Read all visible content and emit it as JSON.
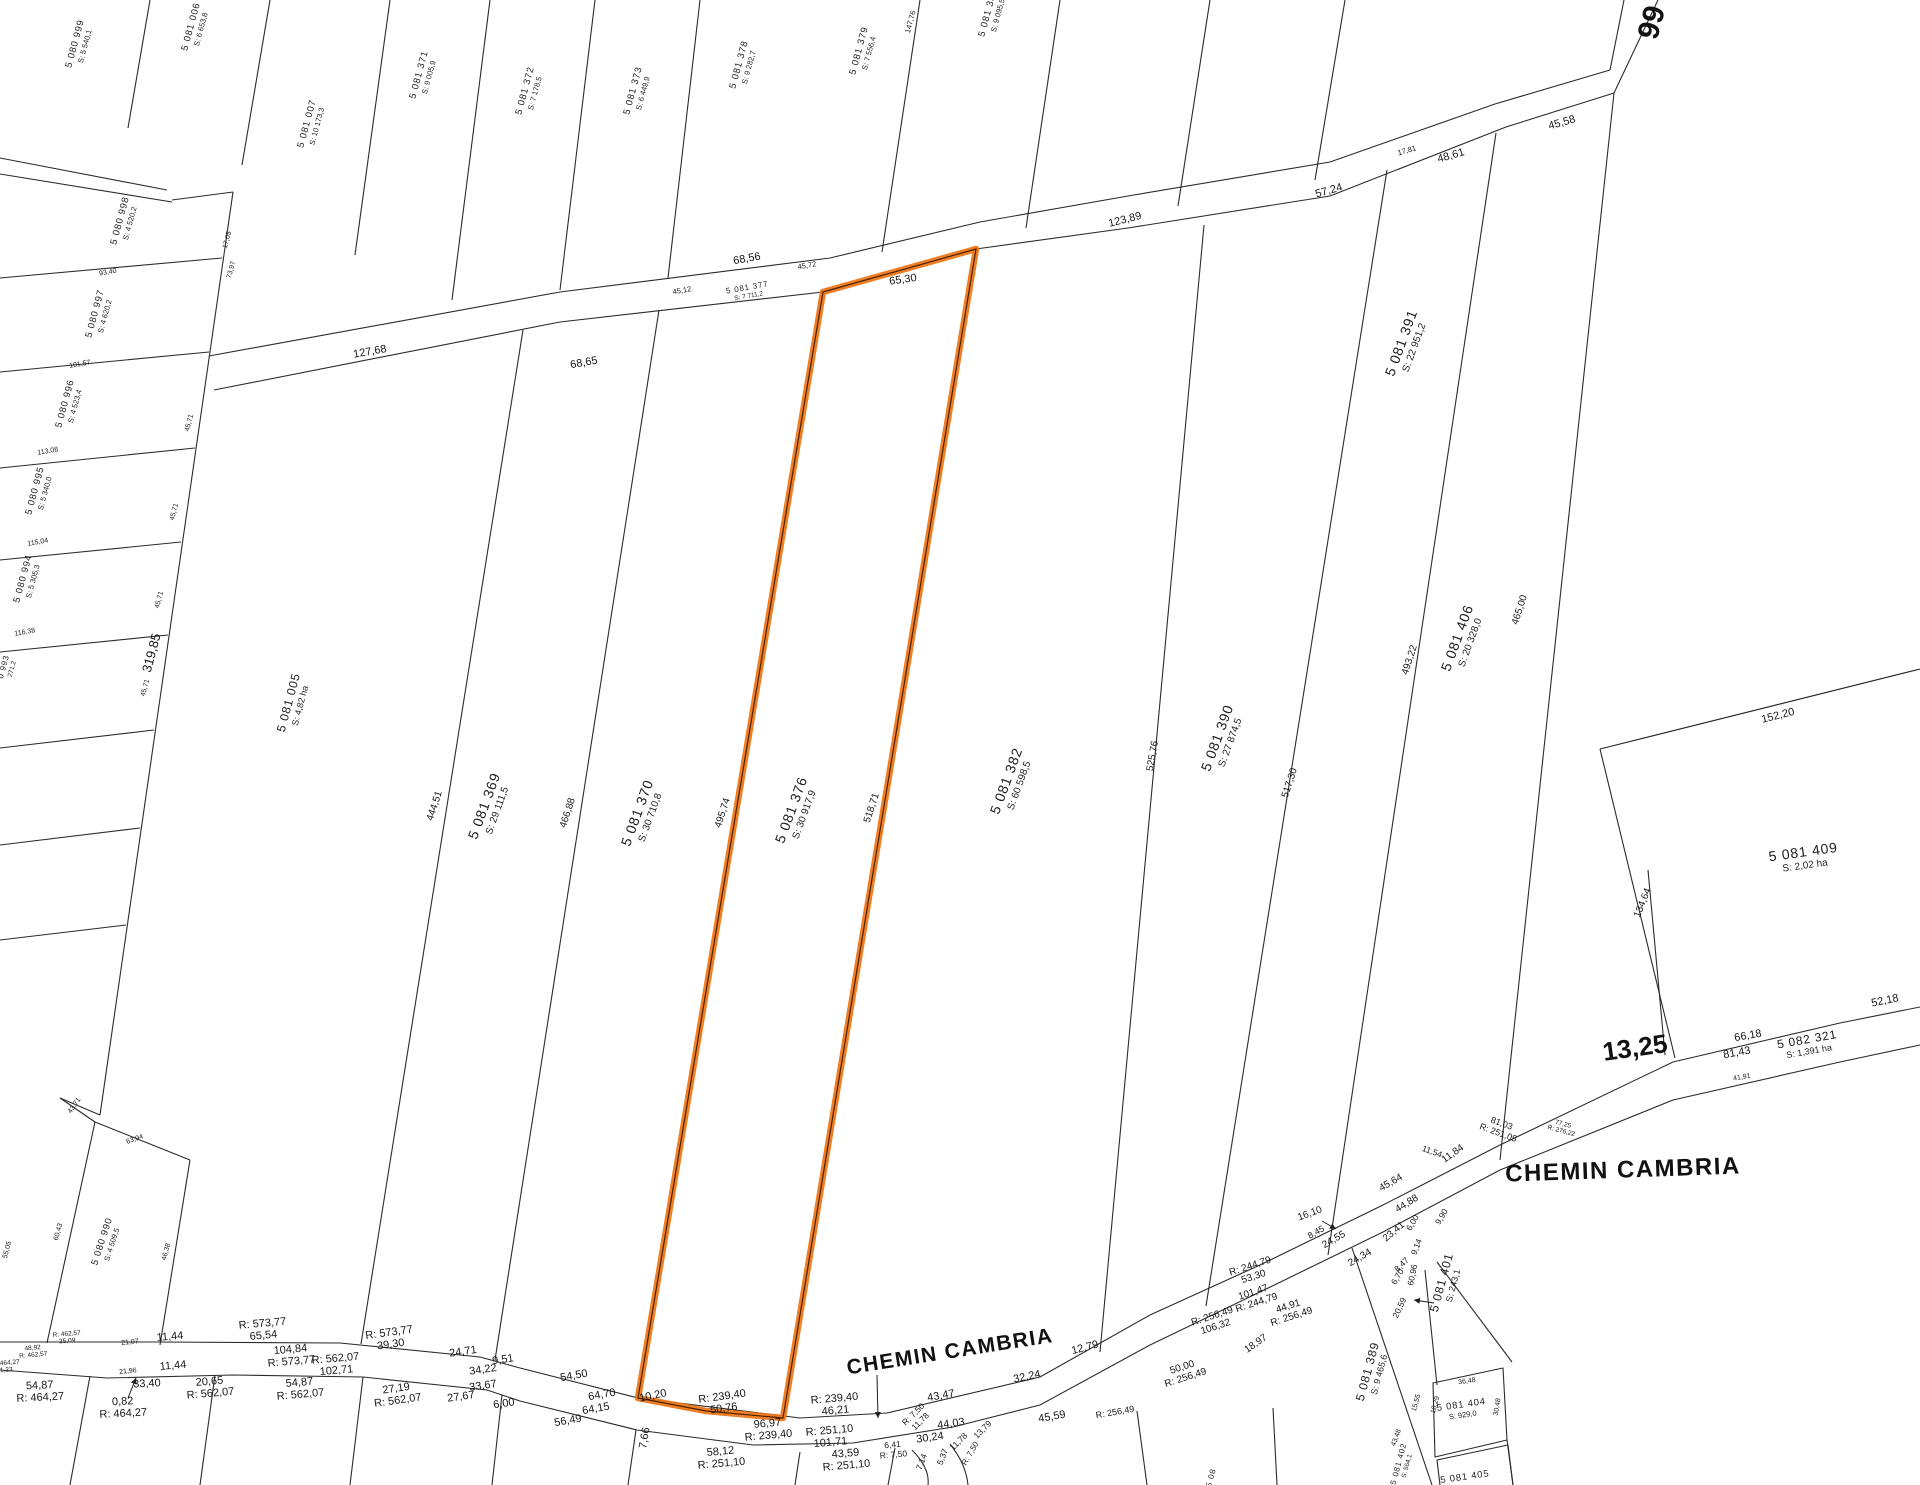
{
  "map": {
    "type": "cadastral-parcel-map",
    "road_name": "CHEMIN CAMBRIA",
    "route_number": "66",
    "highlight_color": "#EE7312",
    "highlight_core_color": "#4a2300",
    "line_color": "#2b2b2b",
    "highlighted_parcel": {
      "id": "5 081 376",
      "area": "S: 30 917,9"
    }
  },
  "parcels": [
    {
      "id": "5 080 999",
      "area": "S: 5 540,1",
      "x": 80,
      "y": 45,
      "r": -75,
      "sz": "sm",
      "hl": false
    },
    {
      "id": "5 081 006",
      "area": "S: 6 653,8",
      "x": 196,
      "y": 28,
      "r": -75,
      "sz": "sm",
      "hl": false
    },
    {
      "id": "5 081 007",
      "area": "S: 10 173,3",
      "x": 312,
      "y": 125,
      "r": -75,
      "sz": "sm",
      "hl": false
    },
    {
      "id": "5 081 371",
      "area": "S: 9 005,9",
      "x": 424,
      "y": 76,
      "r": -75,
      "sz": "sm",
      "hl": false
    },
    {
      "id": "5 081 372",
      "area": "S: 7 178,5",
      "x": 530,
      "y": 92,
      "r": -75,
      "sz": "sm",
      "hl": false
    },
    {
      "id": "5 081 373",
      "area": "S: 6 449,9",
      "x": 638,
      "y": 92,
      "r": -75,
      "sz": "sm",
      "hl": false
    },
    {
      "id": "5 081 378",
      "area": "S: 9 282,7",
      "x": 744,
      "y": 66,
      "r": -75,
      "sz": "sm",
      "hl": false
    },
    {
      "id": "5 081 379",
      "area": "S: 7 556,4",
      "x": 864,
      "y": 52,
      "r": -75,
      "sz": "sm",
      "hl": false
    },
    {
      "id": "5 081 383",
      "area": "S: 9 095,5",
      "x": 993,
      "y": 14,
      "r": -75,
      "sz": "sm",
      "hl": false
    },
    {
      "id": "5 081 377",
      "area": "S: 7 711,2",
      "x": 748,
      "y": 292,
      "r": -10,
      "sz": "xs",
      "hl": false
    },
    {
      "id": "5 080 998",
      "area": "S: 4 520,2",
      "x": 125,
      "y": 222,
      "r": -75,
      "sz": "sm",
      "hl": false
    },
    {
      "id": "5 080 997",
      "area": "S: 4 620,2",
      "x": 100,
      "y": 315,
      "r": -75,
      "sz": "sm",
      "hl": false
    },
    {
      "id": "5 080 996",
      "area": "S: 4 523,4",
      "x": 70,
      "y": 405,
      "r": -75,
      "sz": "sm",
      "hl": false
    },
    {
      "id": "5 080 995",
      "area": "S: 5 340,0",
      "x": 40,
      "y": 492,
      "r": -75,
      "sz": "sm",
      "hl": false
    },
    {
      "id": "5 080 994",
      "area": "S: 5 305,3",
      "x": 28,
      "y": 580,
      "r": -75,
      "sz": "sm",
      "hl": false
    },
    {
      "id": "0 993",
      "area": "271,2",
      "x": 8,
      "y": 668,
      "r": -75,
      "sz": "xs",
      "hl": false
    },
    {
      "id": "5 080 990",
      "area": "S: 4 509,5",
      "x": 107,
      "y": 1243,
      "r": -72,
      "sz": "sm",
      "hl": false
    },
    {
      "id": "5 081 005",
      "area": "S: 4,82  ha",
      "x": 294,
      "y": 704,
      "r": -75,
      "sz": "md",
      "hl": false
    },
    {
      "id": "5 081 369",
      "area": "S: 29 111,5",
      "x": 490,
      "y": 808,
      "r": -70,
      "sz": "lg",
      "hl": false
    },
    {
      "id": "5 081 370",
      "area": "S: 30 710,8",
      "x": 643,
      "y": 815,
      "r": -70,
      "sz": "lg",
      "hl": false
    },
    {
      "id": "5 081 376",
      "area": "S: 30 917,9",
      "x": 797,
      "y": 812,
      "r": -70,
      "sz": "lg",
      "hl": true
    },
    {
      "id": "5 081 382",
      "area": "S: 60 598,5",
      "x": 1012,
      "y": 783,
      "r": -70,
      "sz": "lg",
      "hl": false
    },
    {
      "id": "5 081 390",
      "area": "S: 27 874,5",
      "x": 1223,
      "y": 740,
      "r": -70,
      "sz": "lg",
      "hl": false
    },
    {
      "id": "5 081 391",
      "area": "S: 22 951,2",
      "x": 1407,
      "y": 345,
      "r": -70,
      "sz": "lg",
      "hl": false
    },
    {
      "id": "5 081 406",
      "area": "S: 20 328,0",
      "x": 1463,
      "y": 640,
      "r": -70,
      "sz": "lg",
      "hl": false
    },
    {
      "id": "5 081 409",
      "area": "S: 2,02  ha",
      "x": 1804,
      "y": 858,
      "r": -8,
      "sz": "lg",
      "hl": false
    },
    {
      "id": "5 082 321",
      "area": "S: 1,391 ha",
      "x": 1808,
      "y": 1045,
      "r": -10,
      "sz": "md",
      "hl": false
    },
    {
      "id": "5 081 401",
      "area": "S: 243,1",
      "x": 1447,
      "y": 1284,
      "r": -75,
      "sz": "md",
      "hl": false
    },
    {
      "id": "5 081 389",
      "area": "S: 9 465,6",
      "x": 1373,
      "y": 1373,
      "r": -75,
      "sz": "md",
      "hl": false
    },
    {
      "id": "5 081 402",
      "area": "S: 564,1",
      "x": 1403,
      "y": 1465,
      "r": -75,
      "sz": "xs",
      "hl": false
    },
    {
      "id": "5 081 404",
      "area": "S: 929,0",
      "x": 1462,
      "y": 1410,
      "r": -8,
      "sz": "sm",
      "hl": false
    },
    {
      "id": "5 081 405",
      "area": "",
      "x": 1465,
      "y": 1478,
      "r": -8,
      "sz": "sm",
      "hl": false
    },
    {
      "id": "5 08",
      "area": "",
      "x": 1212,
      "y": 1478,
      "r": -75,
      "sz": "xs",
      "hl": false
    }
  ],
  "measurements": [
    {
      "t": "127,68",
      "x": 370,
      "y": 352,
      "r": -10,
      "s": 11
    },
    {
      "t": "68,65",
      "x": 584,
      "y": 363,
      "r": -10,
      "s": 11
    },
    {
      "t": "68,56",
      "x": 747,
      "y": 259,
      "r": -10,
      "s": 11
    },
    {
      "t": "65,30",
      "x": 903,
      "y": 280,
      "r": -8,
      "s": 11
    },
    {
      "t": "123,89",
      "x": 1125,
      "y": 220,
      "r": -14,
      "s": 11
    },
    {
      "t": "57,24",
      "x": 1329,
      "y": 191,
      "r": -16,
      "s": 11
    },
    {
      "t": "48,61",
      "x": 1451,
      "y": 156,
      "r": -16,
      "s": 11
    },
    {
      "t": "45,58",
      "x": 1562,
      "y": 123,
      "r": -16,
      "s": 11
    },
    {
      "t": "17,81",
      "x": 1407,
      "y": 151,
      "r": -16,
      "s": 7.5
    },
    {
      "t": "45,72",
      "x": 807,
      "y": 266,
      "r": -10,
      "s": 7.5
    },
    {
      "t": "45,12",
      "x": 682,
      "y": 291,
      "r": -10,
      "s": 7.5
    },
    {
      "t": "147,76",
      "x": 911,
      "y": 22,
      "r": -75,
      "s": 7.5
    },
    {
      "t": "444,51",
      "x": 435,
      "y": 806,
      "r": -72,
      "s": 10
    },
    {
      "t": "466,88",
      "x": 568,
      "y": 813,
      "r": -72,
      "s": 10
    },
    {
      "t": "495,74",
      "x": 723,
      "y": 813,
      "r": -72,
      "s": 10
    },
    {
      "t": "518,71",
      "x": 872,
      "y": 808,
      "r": -72,
      "s": 10
    },
    {
      "t": "525,76",
      "x": 1153,
      "y": 756,
      "r": -80,
      "s": 10
    },
    {
      "t": "517,30",
      "x": 1290,
      "y": 783,
      "r": -72,
      "s": 10
    },
    {
      "t": "493,22",
      "x": 1410,
      "y": 660,
      "r": -72,
      "s": 10
    },
    {
      "t": "465,00",
      "x": 1520,
      "y": 610,
      "r": -72,
      "s": 10
    },
    {
      "t": "319,85",
      "x": 152,
      "y": 653,
      "r": -75,
      "s": 13
    },
    {
      "t": "152,20",
      "x": 1778,
      "y": 716,
      "r": -14,
      "s": 11
    },
    {
      "t": "134,64",
      "x": 1643,
      "y": 903,
      "r": -68,
      "s": 10
    },
    {
      "t": "93,40",
      "x": 108,
      "y": 273,
      "r": -10,
      "s": 7
    },
    {
      "t": "101,57",
      "x": 80,
      "y": 365,
      "r": -10,
      "s": 7
    },
    {
      "t": "113,08",
      "x": 48,
      "y": 452,
      "r": -10,
      "s": 7
    },
    {
      "t": "115,04",
      "x": 38,
      "y": 543,
      "r": -10,
      "s": 7
    },
    {
      "t": "116,38",
      "x": 25,
      "y": 633,
      "r": -10,
      "s": 7
    },
    {
      "t": "45,71",
      "x": 190,
      "y": 423,
      "r": -75,
      "s": 7
    },
    {
      "t": "45,71",
      "x": 175,
      "y": 512,
      "r": -75,
      "s": 7
    },
    {
      "t": "45,71",
      "x": 160,
      "y": 600,
      "r": -75,
      "s": 7
    },
    {
      "t": "45,71",
      "x": 146,
      "y": 688,
      "r": -75,
      "s": 7
    },
    {
      "t": "17,05",
      "x": 228,
      "y": 240,
      "r": -75,
      "s": 7
    },
    {
      "t": "73,97",
      "x": 232,
      "y": 270,
      "r": -75,
      "s": 7
    },
    {
      "t": "43,71",
      "x": 75,
      "y": 1106,
      "r": -55,
      "s": 7
    },
    {
      "t": "63,94",
      "x": 135,
      "y": 1140,
      "r": -20,
      "s": 7
    },
    {
      "t": "60,43",
      "x": 59,
      "y": 1232,
      "r": -75,
      "s": 7
    },
    {
      "t": "55,05",
      "x": 8,
      "y": 1250,
      "r": -75,
      "s": 7
    },
    {
      "t": "46,38",
      "x": 167,
      "y": 1252,
      "r": -75,
      "s": 7
    },
    {
      "t": "11,44",
      "x": 170,
      "y": 1337,
      "r": -5,
      "s": 11
    },
    {
      "t": "11,44",
      "x": 173,
      "y": 1366,
      "r": -5,
      "s": 11
    },
    {
      "t": "21,07",
      "x": 130,
      "y": 1343,
      "r": -5,
      "s": 7
    },
    {
      "t": "21,96",
      "x": 128,
      "y": 1372,
      "r": -5,
      "s": 7
    },
    {
      "t": "24,71",
      "x": 463,
      "y": 1352,
      "r": -8,
      "s": 11
    },
    {
      "t": "9,51",
      "x": 503,
      "y": 1360,
      "r": -8,
      "s": 11
    },
    {
      "t": "34,22",
      "x": 483,
      "y": 1370,
      "r": -8,
      "s": 11
    },
    {
      "t": "33,40",
      "x": 147,
      "y": 1384,
      "r": -3,
      "s": 11
    },
    {
      "t": "27,67",
      "x": 461,
      "y": 1397,
      "r": -8,
      "s": 11
    },
    {
      "t": "33,67",
      "x": 483,
      "y": 1386,
      "r": -8,
      "s": 11
    },
    {
      "t": "6,00",
      "x": 504,
      "y": 1404,
      "r": -8,
      "s": 11
    },
    {
      "t": "54,50",
      "x": 574,
      "y": 1376,
      "r": -10,
      "s": 11
    },
    {
      "t": "64,70",
      "x": 602,
      "y": 1395,
      "r": -10,
      "s": 11
    },
    {
      "t": "64,15",
      "x": 596,
      "y": 1409,
      "r": -10,
      "s": 11
    },
    {
      "t": "56,49",
      "x": 568,
      "y": 1421,
      "r": -10,
      "s": 11
    },
    {
      "t": "10,20",
      "x": 653,
      "y": 1396,
      "r": -12,
      "s": 11
    },
    {
      "t": "7,66",
      "x": 645,
      "y": 1438,
      "r": -80,
      "s": 11
    },
    {
      "t": "43,47",
      "x": 941,
      "y": 1396,
      "r": -10,
      "s": 11
    },
    {
      "t": "32,24",
      "x": 1027,
      "y": 1377,
      "r": -12,
      "s": 11
    },
    {
      "t": "44,03",
      "x": 951,
      "y": 1424,
      "r": -8,
      "s": 11
    },
    {
      "t": "30,24",
      "x": 930,
      "y": 1438,
      "r": -8,
      "s": 11
    },
    {
      "t": "45,59",
      "x": 1052,
      "y": 1417,
      "r": -10,
      "s": 11
    },
    {
      "t": "R: 256,49",
      "x": 1115,
      "y": 1412,
      "r": -10,
      "s": 9
    },
    {
      "t": "12,79",
      "x": 1085,
      "y": 1348,
      "r": -15,
      "s": 11
    },
    {
      "t": "18,97",
      "x": 1256,
      "y": 1344,
      "r": -35,
      "s": 10
    },
    {
      "t": "16,10",
      "x": 1310,
      "y": 1214,
      "r": -20,
      "s": 10
    },
    {
      "t": "8,45",
      "x": 1316,
      "y": 1232,
      "r": -30,
      "s": 9
    },
    {
      "t": "24,55",
      "x": 1334,
      "y": 1240,
      "r": -30,
      "s": 10
    },
    {
      "t": "24,34",
      "x": 1360,
      "y": 1258,
      "r": -30,
      "s": 10
    },
    {
      "t": "45,64",
      "x": 1391,
      "y": 1183,
      "r": -30,
      "s": 10
    },
    {
      "t": "44,88",
      "x": 1407,
      "y": 1204,
      "r": -32,
      "s": 10
    },
    {
      "t": "23,41",
      "x": 1394,
      "y": 1232,
      "r": -40,
      "s": 10
    },
    {
      "t": "6,00",
      "x": 1413,
      "y": 1223,
      "r": -60,
      "s": 8.5
    },
    {
      "t": "11,84",
      "x": 1453,
      "y": 1154,
      "r": -35,
      "s": 10
    },
    {
      "t": "9,90",
      "x": 1442,
      "y": 1217,
      "r": -60,
      "s": 8.5
    },
    {
      "t": "9,14",
      "x": 1417,
      "y": 1247,
      "r": -70,
      "s": 8.5
    },
    {
      "t": "8,47",
      "x": 1402,
      "y": 1265,
      "r": -45,
      "s": 8.5
    },
    {
      "t": "6,70",
      "x": 1398,
      "y": 1277,
      "r": -60,
      "s": 8.5
    },
    {
      "t": "60,96",
      "x": 1413,
      "y": 1275,
      "r": -78,
      "s": 8.5
    },
    {
      "t": "20,59",
      "x": 1400,
      "y": 1308,
      "r": -65,
      "s": 8.5
    },
    {
      "t": "11,54",
      "x": 1432,
      "y": 1152,
      "r": 20,
      "s": 8.5
    },
    {
      "t": "52,18",
      "x": 1885,
      "y": 1001,
      "r": -12,
      "s": 11
    },
    {
      "t": "66,18",
      "x": 1748,
      "y": 1036,
      "r": -10,
      "s": 11
    },
    {
      "t": "81,43",
      "x": 1737,
      "y": 1053,
      "r": -10,
      "s": 11
    },
    {
      "t": "41,91",
      "x": 1742,
      "y": 1078,
      "r": -10,
      "s": 7
    },
    {
      "t": "11,78",
      "x": 959,
      "y": 1442,
      "r": -45,
      "s": 8.5
    },
    {
      "t": "13,79",
      "x": 983,
      "y": 1430,
      "r": -45,
      "s": 8.5
    },
    {
      "t": "R: 7,50",
      "x": 971,
      "y": 1454,
      "r": -60,
      "s": 8
    },
    {
      "t": "5,37",
      "x": 943,
      "y": 1457,
      "r": -70,
      "s": 8.5
    },
    {
      "t": "7,14",
      "x": 922,
      "y": 1462,
      "r": -70,
      "s": 8.5
    },
    {
      "t": "43,48",
      "x": 1397,
      "y": 1438,
      "r": -70,
      "s": 7
    },
    {
      "t": "15,55",
      "x": 1417,
      "y": 1403,
      "r": -75,
      "s": 7
    },
    {
      "t": "18,29",
      "x": 1436,
      "y": 1405,
      "r": -75,
      "s": 7
    },
    {
      "t": "36,48",
      "x": 1467,
      "y": 1382,
      "r": -8,
      "s": 7
    },
    {
      "t": "30,48",
      "x": 1498,
      "y": 1407,
      "r": -80,
      "s": 7
    }
  ],
  "measure_pairs": [
    {
      "l1": "R: 573,77",
      "l2": "65,54",
      "x": 263,
      "y": 1330,
      "r": -5,
      "s": 11
    },
    {
      "l1": "104,84",
      "l2": "R: 573,77",
      "x": 291,
      "y": 1356,
      "r": -5,
      "s": 11
    },
    {
      "l1": "R: 562,07",
      "l2": "102,71",
      "x": 336,
      "y": 1365,
      "r": -5,
      "s": 11
    },
    {
      "l1": "R: 573,77",
      "l2": "39,30",
      "x": 390,
      "y": 1339,
      "r": -8,
      "s": 11
    },
    {
      "l1": "R: 462,57",
      "l2": "25,09",
      "x": 67,
      "y": 1338,
      "r": -5,
      "s": 6.5
    },
    {
      "l1": "48,92",
      "l2": "R: 462,57",
      "x": 33,
      "y": 1352,
      "r": -5,
      "s": 6.5
    },
    {
      "l1": "R: 464,27",
      "l2": "1,23",
      "x": 6,
      "y": 1367,
      "r": -5,
      "s": 6.5
    },
    {
      "l1": "54,87",
      "l2": "R: 464,27",
      "x": 40,
      "y": 1392,
      "r": -3,
      "s": 11
    },
    {
      "l1": "0,82",
      "l2": "R: 464,27",
      "x": 123,
      "y": 1408,
      "r": -3,
      "s": 11
    },
    {
      "l1": "20,65",
      "l2": "R: 562,07",
      "x": 210,
      "y": 1388,
      "r": -5,
      "s": 11
    },
    {
      "l1": "54,87",
      "l2": "R: 562,07",
      "x": 300,
      "y": 1389,
      "r": -5,
      "s": 11
    },
    {
      "l1": "27,19",
      "l2": "R: 562,07",
      "x": 397,
      "y": 1395,
      "r": -8,
      "s": 11
    },
    {
      "l1": "R: 239,40",
      "l2": "50,76",
      "x": 723,
      "y": 1403,
      "r": -8,
      "s": 11
    },
    {
      "l1": "96,97",
      "l2": "R: 239,40",
      "x": 768,
      "y": 1430,
      "r": -5,
      "s": 11
    },
    {
      "l1": "R: 239,40",
      "l2": "46,21",
      "x": 835,
      "y": 1405,
      "r": -5,
      "s": 11
    },
    {
      "l1": "R: 251,10",
      "l2": "101,71",
      "x": 830,
      "y": 1437,
      "r": -5,
      "s": 11
    },
    {
      "l1": "58,12",
      "l2": "R: 251,10",
      "x": 721,
      "y": 1458,
      "r": -5,
      "s": 11
    },
    {
      "l1": "43,59",
      "l2": "R: 251,10",
      "x": 846,
      "y": 1460,
      "r": -5,
      "s": 11
    },
    {
      "l1": "6,41",
      "l2": "R: 7,50",
      "x": 893,
      "y": 1450,
      "r": -5,
      "s": 8.5
    },
    {
      "l1": "R: 7,50",
      "l2": "11,78",
      "x": 917,
      "y": 1418,
      "r": -45,
      "s": 8.5
    },
    {
      "l1": "R: 244,79",
      "l2": "53,30",
      "x": 1252,
      "y": 1272,
      "r": -18,
      "s": 10
    },
    {
      "l1": "101,47",
      "l2": "R: 244,79",
      "x": 1255,
      "y": 1298,
      "r": -18,
      "s": 10
    },
    {
      "l1": "R: 256,49",
      "l2": "106,32",
      "x": 1214,
      "y": 1322,
      "r": -18,
      "s": 10
    },
    {
      "l1": "44,91",
      "l2": "R: 256,49",
      "x": 1290,
      "y": 1312,
      "r": -18,
      "s": 10
    },
    {
      "l1": "50,00",
      "l2": "R: 256,49",
      "x": 1184,
      "y": 1373,
      "r": -18,
      "s": 10
    },
    {
      "l1": "81,03",
      "l2": "R: 251,05",
      "x": 1500,
      "y": 1128,
      "r": 20,
      "s": 9
    },
    {
      "l1": "77,25",
      "l2": "R: 276,22",
      "x": 1562,
      "y": 1128,
      "r": 15,
      "s": 6.5
    }
  ],
  "road_labels": [
    {
      "t": "CHEMIN CAMBRIA",
      "x": 950,
      "y": 1352,
      "r": -9,
      "s": 21,
      "kind": "road"
    },
    {
      "t": "CHEMIN CAMBRIA",
      "x": 1623,
      "y": 1171,
      "r": -2,
      "s": 24,
      "kind": "road"
    },
    {
      "t": "13,25",
      "x": 1635,
      "y": 1048,
      "r": -8,
      "s": 26,
      "kind": "num"
    },
    {
      "t": "66",
      "x": 1650,
      "y": 22,
      "r": 105,
      "s": 30,
      "kind": "num"
    }
  ]
}
